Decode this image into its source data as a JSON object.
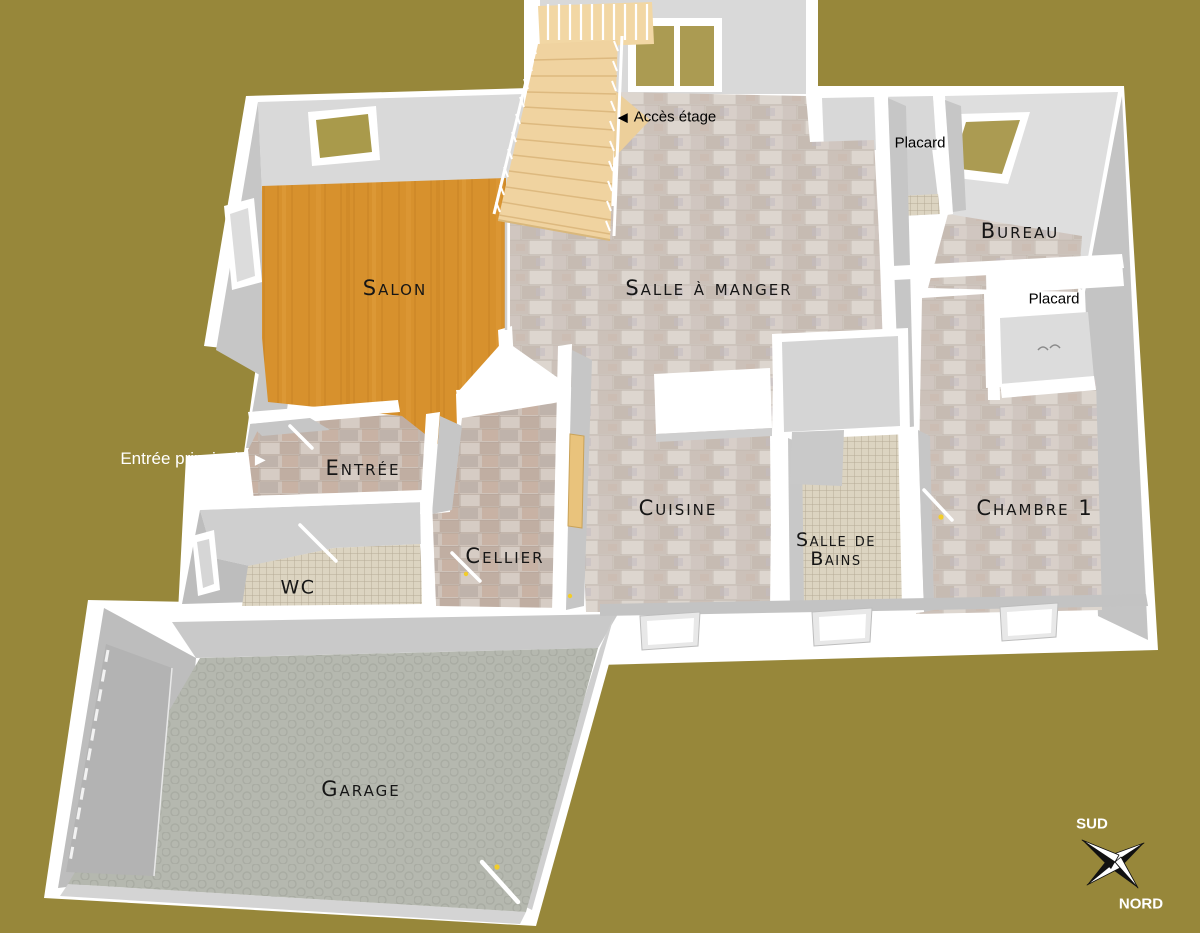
{
  "scene": {
    "description": "3D rendered ground-floor plan of a house, viewed from above",
    "background_color": "#97873a"
  },
  "rooms": {
    "salon": {
      "label": "Salon"
    },
    "salle_a_manger": {
      "label": "Salle à manger"
    },
    "bureau": {
      "label": "Bureau"
    },
    "cuisine": {
      "label": "Cuisine"
    },
    "salle_de_bains": {
      "label_line1": "Salle de",
      "label_line2": "Bains"
    },
    "chambre_1": {
      "label": "Chambre 1"
    },
    "cellier": {
      "label": "Cellier"
    },
    "entree": {
      "label": "Entrée"
    },
    "wc": {
      "label": "WC"
    },
    "garage": {
      "label": "Garage"
    }
  },
  "closets": {
    "hall": {
      "label": "Placard"
    },
    "chambre": {
      "label": "Placard"
    }
  },
  "annotations": {
    "acces_etage": {
      "arrow": "◀",
      "label": "Accès étage"
    },
    "entree_principale": {
      "label": "Entrée principale",
      "arrow": "▶"
    }
  },
  "compass": {
    "south": "SUD",
    "north": "NORD"
  },
  "palette": {
    "background": "#97873a",
    "walls": "#ffffff",
    "wall_face_light": "#d9d9d9",
    "wall_face_dark": "#c2c2c2",
    "wood_floor": "#d7912d",
    "stair_wood": "#f0d3a0",
    "stone_tile": "#d5cec7",
    "warm_tile": "#cfc3ba",
    "mosaic_tile": "#dcd4c1",
    "garage_floor": "#b5b8af",
    "window_pane_olive": "#ab9b52",
    "door_handle_yellow": "#f2cd2a",
    "label_color": "#161616"
  }
}
